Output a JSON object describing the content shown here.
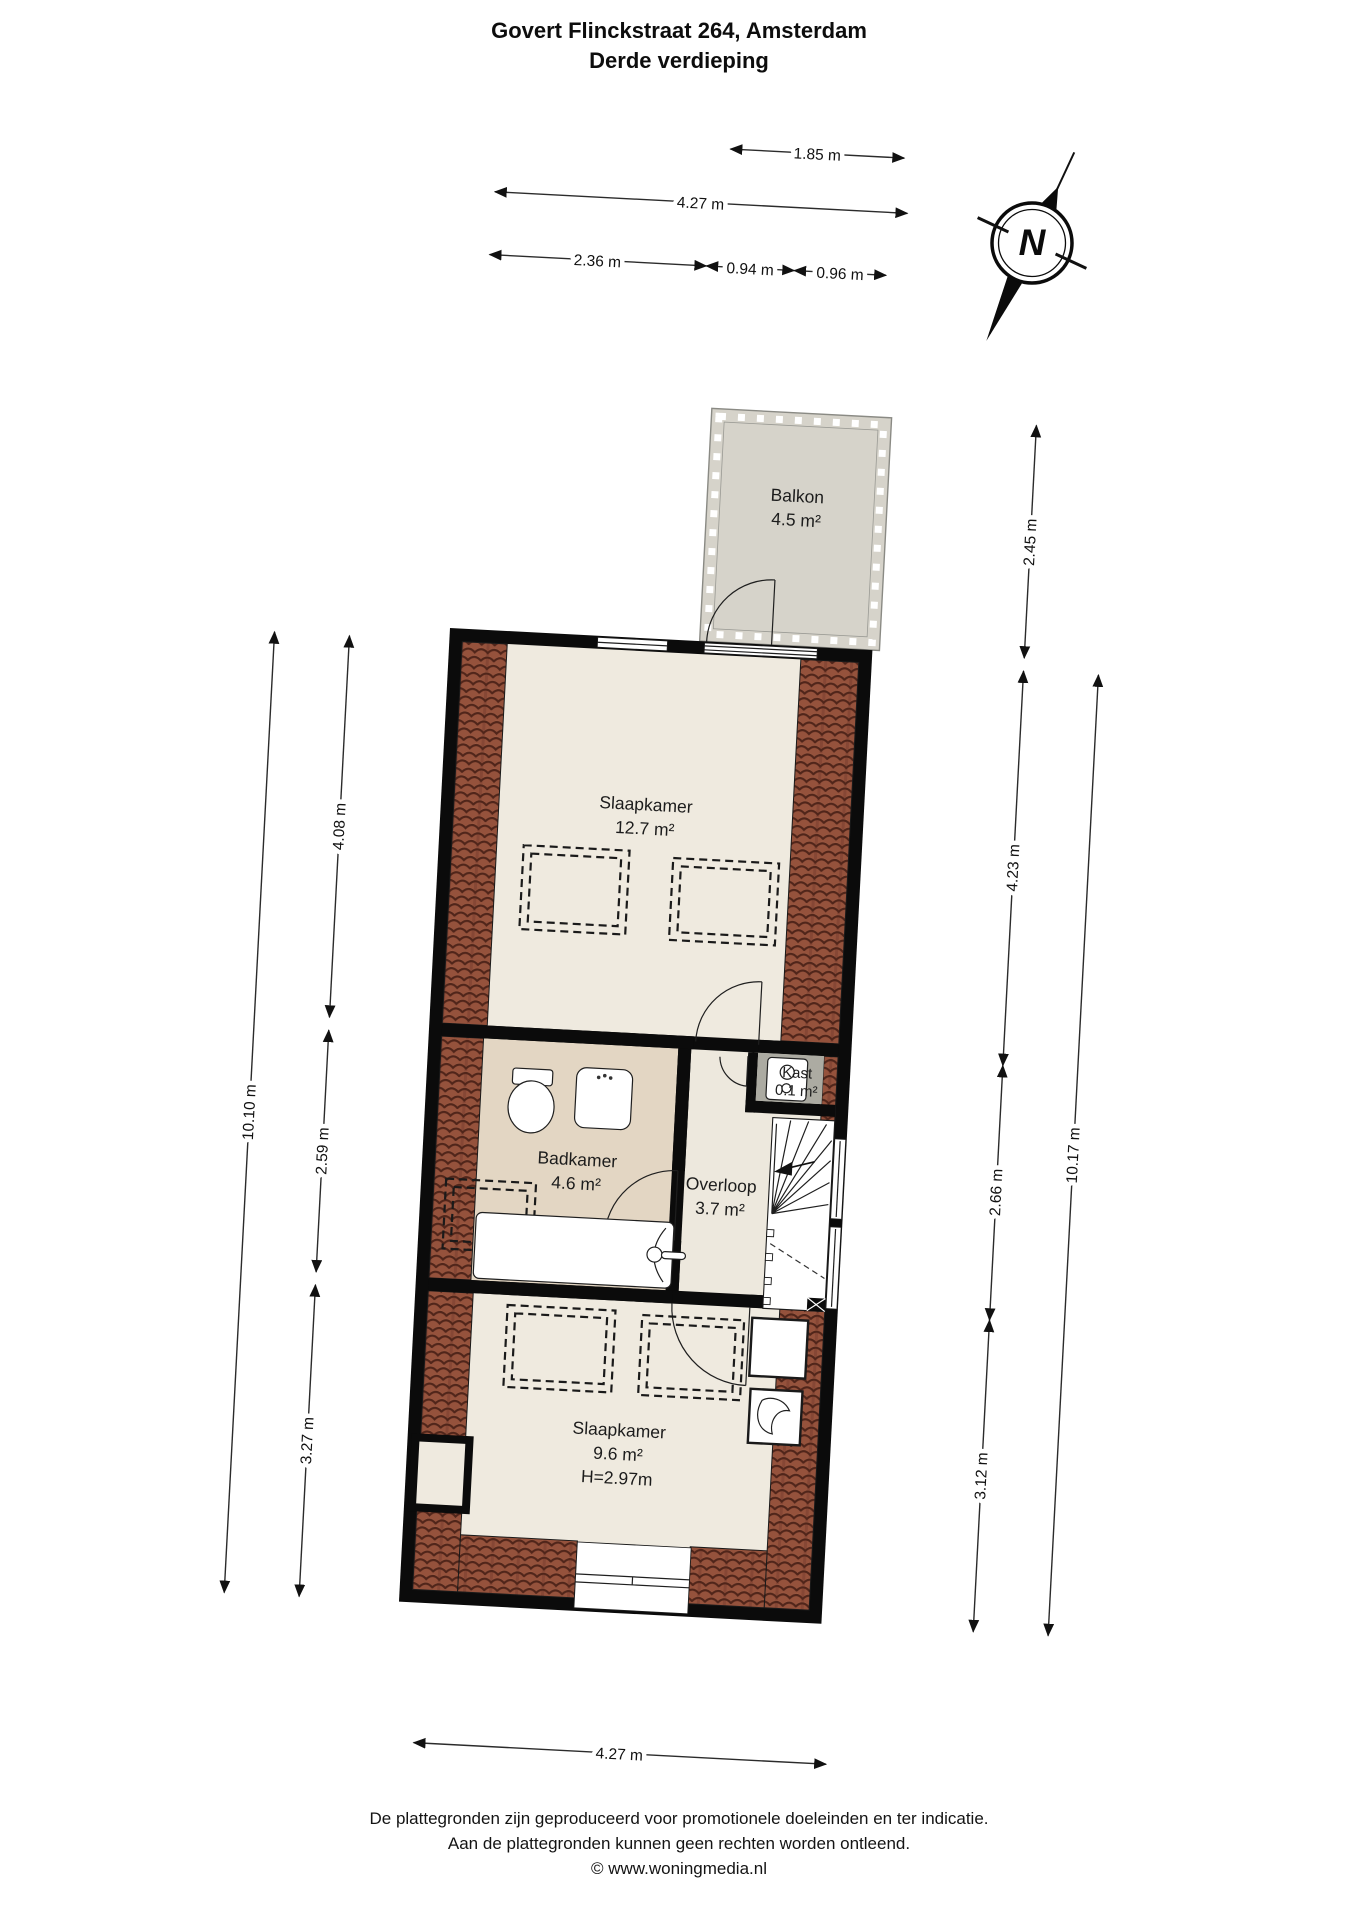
{
  "title": {
    "line1": "Govert Flinckstraat 264, Amsterdam",
    "line2": "Derde verdieping"
  },
  "compass": {
    "label": "N"
  },
  "rooms": {
    "balkon": {
      "name": "Balkon",
      "area": "4.5 m²"
    },
    "slaapkamer_boven": {
      "name": "Slaapkamer",
      "area": "12.7 m²"
    },
    "badkamer": {
      "name": "Badkamer",
      "area": "4.6 m²"
    },
    "overloop": {
      "name": "Overloop",
      "area": "3.7 m²"
    },
    "kast": {
      "name": "Kast",
      "area": "0.1 m²"
    },
    "slaapkamer_onder": {
      "name": "Slaapkamer",
      "area": "9.6 m²",
      "height": "H=2.97m"
    }
  },
  "dimensions": {
    "top_row1": "1.85 m",
    "top_row2": "4.27 m",
    "top_row3a": "2.36 m",
    "top_row3b": "0.94 m",
    "top_row3c": "0.96 m",
    "left_total": "10.10 m",
    "left_s1": "4.08 m",
    "left_s2": "2.59 m",
    "left_s3": "3.27 m",
    "right_balkon": "2.45 m",
    "right_s1": "4.23 m",
    "right_s2": "2.66 m",
    "right_s3": "3.12 m",
    "right_total": "10.17 m",
    "bottom": "4.27 m"
  },
  "footer": {
    "line1": "De plattegronden zijn geproduceerd voor promotionele doeleinden en ter indicatie.",
    "line2": "Aan de plattegronden kunnen geen rechten worden ontleend.",
    "line3": "© www.woningmedia.nl"
  },
  "colors": {
    "floor": "#EFEADF",
    "bathroom_floor": "#E3D6C3",
    "balcony_floor": "#D6D3CA",
    "closet_floor": "#ACABA2",
    "roof_tiles": "#95523C",
    "walls": "#0B0B0B"
  }
}
